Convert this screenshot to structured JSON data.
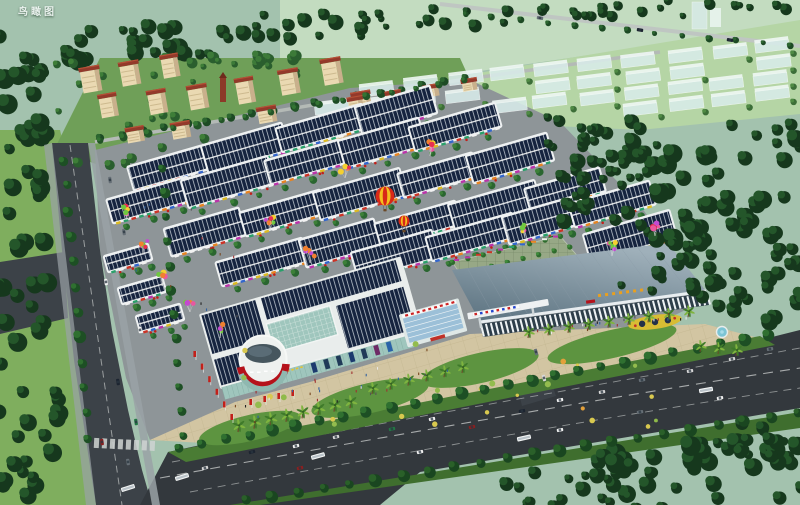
{
  "label": {
    "text": "鸟瞰图"
  },
  "palette": {
    "haze": "#a3c2ae",
    "far_fields": "#c3dcc0",
    "ghost_zone_grass": "#b5d5a5",
    "ghost_building": "#d9ecea",
    "ghost_building_top": "#eef7f4",
    "forest_dark": "#16381d",
    "forest_mid": "#24562a",
    "tree_light": "#3f8a3b",
    "lawn": "#7fae5e",
    "verge_green": "#4a7c34",
    "asphalt": "#3c4248",
    "asphalt_dark": "#33383d",
    "sidewalk": "#9aa2a6",
    "platform": "#8e9598",
    "plaza_tan": "#d2c5a2",
    "market_roof_navy": "#16243f",
    "canopy_white": "#eef1f2",
    "residential_wall": "#ead9b2",
    "residential_side": "#c9b08c",
    "residential_roof": "#93392a",
    "mall_glass": "#9fc6bd",
    "mall_white": "#e9edec",
    "drum_dome": "#46565e",
    "expo_roof_front": "#59707e",
    "expo_roof_back": "#9fb0ba",
    "expo_facade": "#2e3e4a",
    "accent_red": "#b5121b",
    "accent_yellow": "#e8c22a",
    "roof_text_orange": "#e8a020",
    "balloon_pink": "#e957a0",
    "flowerbed_yellow": "#d8bc34",
    "fountain_blue": "#7cc4d4"
  },
  "signs": {
    "mall_drum_banner_color": "#b5121b",
    "mall_annex_band_color": "#cc2222",
    "exhibition_roof_text_color": "#e8a020",
    "skybridge_sign_colors": [
      "#cc2222",
      "#2244cc"
    ]
  }
}
